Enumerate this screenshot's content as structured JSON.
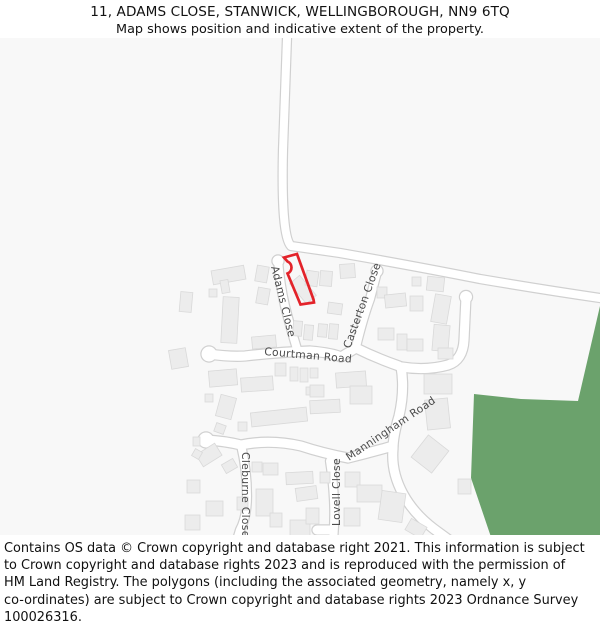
{
  "header": {
    "title": "11, ADAMS CLOSE, STANWICK, WELLINGBOROUGH, NN9 6TQ",
    "subtitle": "Map shows position and indicative extent of the property."
  },
  "footer": {
    "lines": [
      "Contains OS data © Crown copyright and database right 2021. This information is subject",
      "to Crown copyright and database rights 2023 and is reproduced with the permission of",
      "HM Land Registry. The polygons (including the associated geometry, namely x, y",
      "co-ordinates) are subject to Crown copyright and database rights 2023 Ordnance Survey",
      "100026316."
    ]
  },
  "map": {
    "colors": {
      "background": "#f8f8f8",
      "road_fill": "#ffffff",
      "road_casing": "#d0d0d0",
      "building_fill": "#ececec",
      "building_stroke": "#d9d9d9",
      "label": "#4c4c4c",
      "green_area": "#6ba26c",
      "property_outline": "#e3232a"
    },
    "green_area": {
      "d": "M600,306 L578,401 L521,399 L474,394 L471,478 L492,540 L600,540 Z"
    },
    "property": {
      "d": "M284,257.5 L297,254 L313.5,299.5 L314,302.5 L300.5,304.5 L287.5,273.5 A6.5,6.5 0 0 0 287.5,261.5 Z",
      "width": 2.7
    },
    "roads": [
      {
        "id": "main-road",
        "d": "M287,38 L283,150 Q281,236 291,246 L340,253 Q420,267 480,279 Q545,290 600,298",
        "w": 8
      },
      {
        "id": "adams-close",
        "d": "M278,260 Q280,285 285,306 Q290,326 297,349",
        "w": 8
      },
      {
        "id": "courtman-road",
        "d": "M209,354 Q230,357 245,356 Q280,352 310,351 Q333,353 341,357 L356,348 Q376,358 399,366",
        "w": 9
      },
      {
        "id": "casterton-close",
        "d": "M356,347 Q363,318 370,299 L377,272",
        "w": 8
      },
      {
        "id": "manningham-road-north",
        "d": "M466,297 L464,340 Q463,360 448,365 Q426,371 402,367",
        "w": 9
      },
      {
        "id": "manningham-road-south",
        "d": "M401,367 Q405,390 399,416 Q393,436 393,449 Q391,472 403,494 Q414,514 434,529 L449,540",
        "w": 9
      },
      {
        "id": "west-spur",
        "d": "M206,440 Q225,441 241,445 Q270,439 301,446 Q322,453 348,458 Q372,452 393,446",
        "w": 9
      },
      {
        "id": "cleburne-close",
        "d": "M241,445 Q247,470 247,496 Q247,517 240,530 L237,540",
        "w": 8
      },
      {
        "id": "lovell-close",
        "d": "M330,461 Q333,480 334,500 Q335,521 333,540",
        "w": 8
      },
      {
        "id": "lovell-close-turning",
        "d": "M332,530 L317,530",
        "w": 9
      }
    ],
    "road_ends": [
      [
        278,
        261,
        5.5
      ],
      [
        209,
        354,
        7.5
      ],
      [
        377,
        271,
        5.5
      ],
      [
        466,
        297,
        6
      ],
      [
        206,
        440,
        7.5
      ]
    ],
    "labels": [
      {
        "id": "adams-close",
        "text": "Adams Close",
        "x": 271,
        "y": 267,
        "rot": 76
      },
      {
        "id": "courtman-road",
        "text": "Courtman Road",
        "x": 264,
        "y": 355,
        "rot": 5
      },
      {
        "id": "casterton-close",
        "text": "Casterton Close",
        "x": 350,
        "y": 349,
        "rot": -70
      },
      {
        "id": "manningham-road",
        "text": "Manningham Road",
        "x": 349,
        "y": 461,
        "rot": -34
      },
      {
        "id": "lovell-close",
        "text": "Lovell Close",
        "x": 340,
        "y": 526,
        "rot": -90
      },
      {
        "id": "cleburne-close",
        "text": "Cleburne Close",
        "x": 242,
        "y": 452,
        "rot": 90
      }
    ],
    "buildings": [
      [
        170,
        349,
        17,
        19,
        -10
      ],
      [
        180,
        292,
        12,
        20,
        5
      ],
      [
        212,
        268,
        33,
        14,
        -10
      ],
      [
        221,
        280,
        8,
        13,
        -10
      ],
      [
        209,
        289,
        8,
        8,
        0
      ],
      [
        222,
        297,
        16,
        46,
        3
      ],
      [
        256,
        266,
        12,
        16,
        10
      ],
      [
        257,
        288,
        12,
        16,
        10
      ],
      [
        290,
        283,
        26,
        13,
        50
      ],
      [
        306,
        271,
        12,
        15,
        8
      ],
      [
        320,
        271,
        12,
        15,
        4
      ],
      [
        340,
        264,
        15,
        14,
        -4
      ],
      [
        328,
        303,
        14,
        11,
        8
      ],
      [
        293,
        321,
        9,
        15,
        5
      ],
      [
        304,
        325,
        9,
        15,
        5
      ],
      [
        318,
        324,
        9,
        13,
        5
      ],
      [
        329,
        324,
        9,
        15,
        5
      ],
      [
        252,
        336,
        24,
        12,
        -5
      ],
      [
        377,
        287,
        10,
        11,
        0
      ],
      [
        385,
        294,
        21,
        13,
        -6
      ],
      [
        410,
        296,
        13,
        15,
        0
      ],
      [
        412,
        277,
        9,
        9,
        0
      ],
      [
        427,
        277,
        17,
        14,
        6
      ],
      [
        433,
        295,
        16,
        28,
        10
      ],
      [
        433,
        325,
        16,
        26,
        5
      ],
      [
        438,
        348,
        15,
        11,
        0
      ],
      [
        378,
        328,
        16,
        12,
        0
      ],
      [
        397,
        334,
        10,
        16,
        0
      ],
      [
        407,
        339,
        16,
        12,
        0
      ],
      [
        209,
        370,
        28,
        16,
        -5
      ],
      [
        218,
        396,
        16,
        22,
        15
      ],
      [
        205,
        394,
        8,
        8,
        0
      ],
      [
        215,
        424,
        10,
        9,
        20
      ],
      [
        241,
        377,
        32,
        14,
        -4
      ],
      [
        251,
        410,
        56,
        14,
        -6
      ],
      [
        310,
        400,
        30,
        13,
        -3
      ],
      [
        238,
        422,
        9,
        9,
        0
      ],
      [
        306,
        387,
        8,
        8,
        0
      ],
      [
        275,
        363,
        11,
        13,
        0
      ],
      [
        290,
        367,
        8,
        14,
        0
      ],
      [
        300,
        368,
        8,
        14,
        0
      ],
      [
        310,
        368,
        8,
        10,
        0
      ],
      [
        336,
        372,
        30,
        15,
        -4
      ],
      [
        350,
        386,
        22,
        18,
        0
      ],
      [
        310,
        385,
        14,
        12,
        0
      ],
      [
        424,
        374,
        28,
        20,
        0
      ],
      [
        426,
        399,
        23,
        30,
        -6
      ],
      [
        417,
        440,
        26,
        28,
        38
      ],
      [
        458,
        479,
        13,
        15,
        0
      ],
      [
        198,
        448,
        22,
        14,
        -32
      ],
      [
        223,
        461,
        13,
        10,
        -30
      ],
      [
        187,
        480,
        13,
        13,
        0
      ],
      [
        206,
        501,
        17,
        15,
        0
      ],
      [
        185,
        515,
        15,
        15,
        0
      ],
      [
        237,
        497,
        11,
        13,
        0
      ],
      [
        252,
        462,
        10,
        10,
        0
      ],
      [
        263,
        463,
        15,
        12,
        0
      ],
      [
        286,
        472,
        27,
        12,
        -3
      ],
      [
        256,
        489,
        17,
        27,
        0
      ],
      [
        290,
        520,
        20,
        17,
        0
      ],
      [
        270,
        513,
        12,
        14,
        0
      ],
      [
        320,
        472,
        10,
        11,
        0
      ],
      [
        296,
        487,
        21,
        13,
        -8
      ],
      [
        306,
        508,
        13,
        16,
        0
      ],
      [
        345,
        472,
        15,
        15,
        0
      ],
      [
        357,
        485,
        25,
        17,
        0
      ],
      [
        344,
        508,
        16,
        18,
        0
      ],
      [
        380,
        492,
        24,
        29,
        8
      ],
      [
        407,
        522,
        18,
        13,
        30
      ],
      [
        193,
        437,
        7,
        9,
        0
      ],
      [
        193,
        450,
        8,
        8,
        30
      ]
    ]
  }
}
